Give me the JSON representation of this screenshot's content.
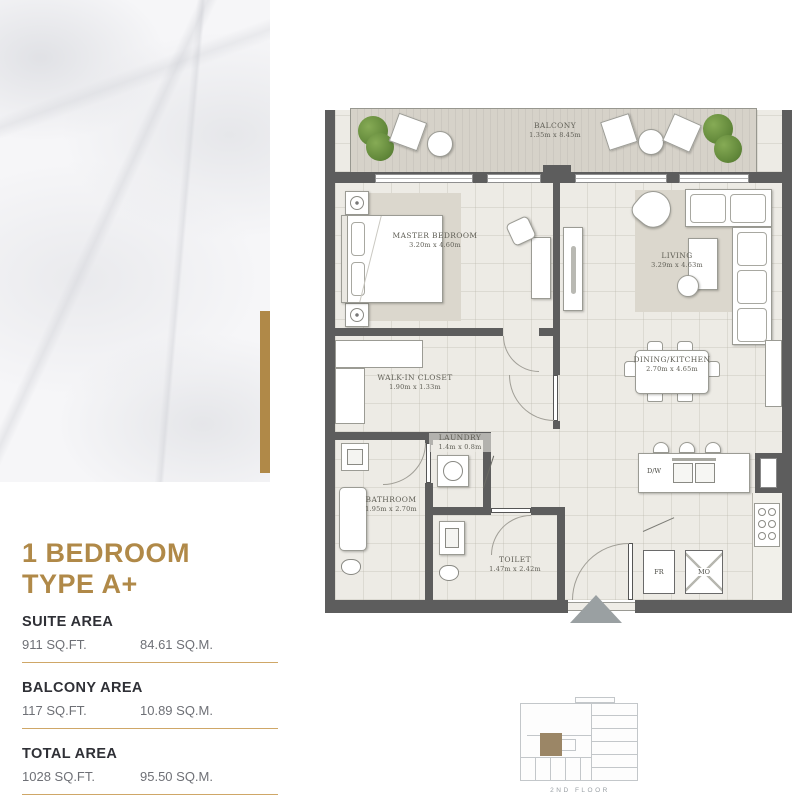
{
  "panel": {
    "title_line1": "1 BEDROOM",
    "title_line2": "TYPE A+",
    "areas": [
      {
        "label": "SUITE AREA",
        "sqft": "911 SQ.FT.",
        "sqm": "84.61 SQ.M."
      },
      {
        "label": "BALCONY AREA",
        "sqft": "117 SQ.FT.",
        "sqm": "10.89 SQ.M."
      },
      {
        "label": "TOTAL AREA",
        "sqft": "1028 SQ.FT.",
        "sqm": "95.50 SQ.M."
      }
    ]
  },
  "floorplan": {
    "rooms": {
      "balcony": {
        "name": "BALCONY",
        "dims": "1.35m x 8.45m"
      },
      "master_bedroom": {
        "name": "MASTER BEDROOM",
        "dims": "3.20m x 4.60m"
      },
      "living": {
        "name": "LIVING",
        "dims": "3.29m x 4.63m"
      },
      "dining_kitchen": {
        "name": "DINING/KITCHEN",
        "dims": "2.70m x 4.65m"
      },
      "walk_in_closet": {
        "name": "WALK-IN CLOSET",
        "dims": "1.90m x 1.33m"
      },
      "laundry": {
        "name": "LAUNDRY",
        "dims": "1.4m x 0.8m"
      },
      "bathroom": {
        "name": "BATHROOM",
        "dims": "1.95m x 2.70m"
      },
      "toilet": {
        "name": "TOILET",
        "dims": "1.47m x 2.42m"
      }
    },
    "appliances": {
      "dishwasher": "D/W",
      "fridge": "FR",
      "microwave": "MO"
    }
  },
  "keyplan": {
    "floor_label": "2ND FLOOR"
  },
  "colors": {
    "gold": "#B08948",
    "gold_line": "#CFA767",
    "wall": "#5D5D5D",
    "floor": "#EDEBE5",
    "balcony": "#D3CFC6",
    "rug": "#DBD7CD",
    "plant_green": "#5F8538",
    "keyplan_unit": "#9B8666",
    "text_dark": "#2F3036",
    "text_gray": "#6E7076",
    "arrow_gray": "#9AA0A2"
  }
}
